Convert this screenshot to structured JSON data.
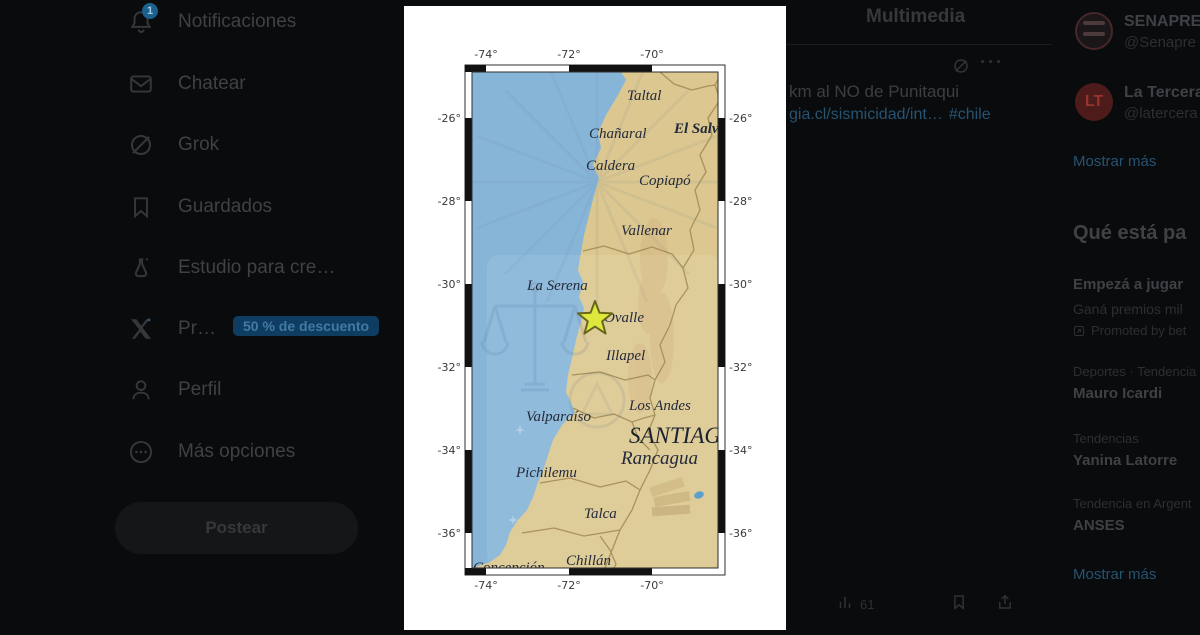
{
  "theme": {
    "bg": "#0a0b0c",
    "map_ocean": "#87b5d8",
    "map_land": "#dbc78f",
    "star_fill": "#dde73c",
    "dim_link": "#265372"
  },
  "sidebar": {
    "items": [
      {
        "icon": "bell-icon",
        "label": "Notificaciones",
        "badge": "1"
      },
      {
        "icon": "envelope-icon",
        "label": "Chatear"
      },
      {
        "icon": "grok-icon",
        "label": "Grok"
      },
      {
        "icon": "bookmark-icon",
        "label": "Guardados"
      },
      {
        "icon": "flask-icon",
        "label": "Estudio para cre…"
      },
      {
        "icon": "x-logo-icon",
        "label": "Pr…",
        "pill": "50 % de descuento"
      },
      {
        "icon": "person-icon",
        "label": "Perfil"
      },
      {
        "icon": "more-circle-icon",
        "label": "Más opciones"
      }
    ],
    "post_button": "Postear"
  },
  "main": {
    "tab_title": "Multimedia",
    "menu_dots": "···",
    "tweet": {
      "text_fragment": "km al NO de Punitaqui",
      "link": "gia.cl/sismicidad/int…",
      "hashtag": "#chile"
    },
    "actions": {
      "views": "61"
    }
  },
  "right_sidebar": {
    "relevant": [
      {
        "name": "SENAPRE",
        "handle": "@Senapre",
        "avatar": "SENAPRED-logo"
      },
      {
        "name": "La Tercera",
        "handle": "@latercera",
        "avatar_text": "LT"
      }
    ],
    "relevant_show_more": "Mostrar más",
    "trends": {
      "header": "Qué está pa",
      "items": [
        {
          "title": "Empezá a jugar",
          "subtitle": "Ganá premios mil",
          "promoted": "Promoted by bet"
        },
        {
          "category": "Deportes · Tendencia",
          "title": "Mauro Icardi"
        },
        {
          "category": "Tendencias",
          "title": "Yanina Latorre"
        },
        {
          "category": "Tendencia en Argent",
          "title": "ANSES"
        }
      ],
      "show_more": "Mostrar más"
    }
  },
  "map": {
    "top_ticks": [
      "-74°",
      "-72°",
      "-70°"
    ],
    "bottom_ticks": [
      "-74°",
      "-72°",
      "-70°"
    ],
    "left_ticks": [
      "-26°",
      "-28°",
      "-30°",
      "-32°",
      "-34°",
      "-36°"
    ],
    "right_ticks": [
      "-26°",
      "-28°",
      "-30°",
      "-32°",
      "-34°",
      "-36°"
    ],
    "cities": [
      "Taltal",
      "Chañaral",
      "El Salvador",
      "Caldera",
      "Copiapó",
      "Vallenar",
      "La Serena",
      "Ovalle",
      "Illapel",
      "Los Andes",
      "Valparaíso",
      "Rancagua",
      "Pichilemu",
      "Talca",
      "Chillán",
      "Concepción"
    ],
    "capital": "SANTIAGO",
    "epicenter": "star near Ovalle"
  }
}
